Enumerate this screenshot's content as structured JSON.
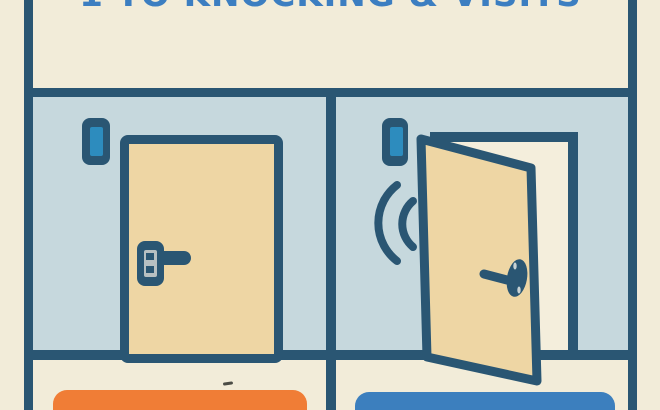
{
  "title": {
    "text": "1 TO KNOCKING & VISITS",
    "note": "title is cropped; only bottom edge of letters visible"
  },
  "panels": {
    "left": {
      "name": "closed-door-panel",
      "door_state": "closed",
      "icons": [
        "doorbell-icon",
        "door-handle-icon"
      ],
      "caption_label": "",
      "caption_color": "#f07d36"
    },
    "right": {
      "name": "open-door-panel",
      "door_state": "open",
      "icons": [
        "doorbell-icon",
        "knock-sound-waves-icon",
        "door-knob-icon"
      ],
      "caption_label": "",
      "caption_color": "#3c7fbe"
    }
  },
  "colors": {
    "background_cream": "#f2ecd9",
    "outline_dark_blue": "#2a5673",
    "wall_light_blue": "#c6d8dd",
    "door_tan": "#eed6a4",
    "doorbell_blue": "#2d8cbe",
    "title_blue": "#3c7ec1",
    "caption_orange": "#f07d36",
    "caption_blue": "#3c7fbe",
    "keyplate_gray": "#b7c0c2"
  }
}
